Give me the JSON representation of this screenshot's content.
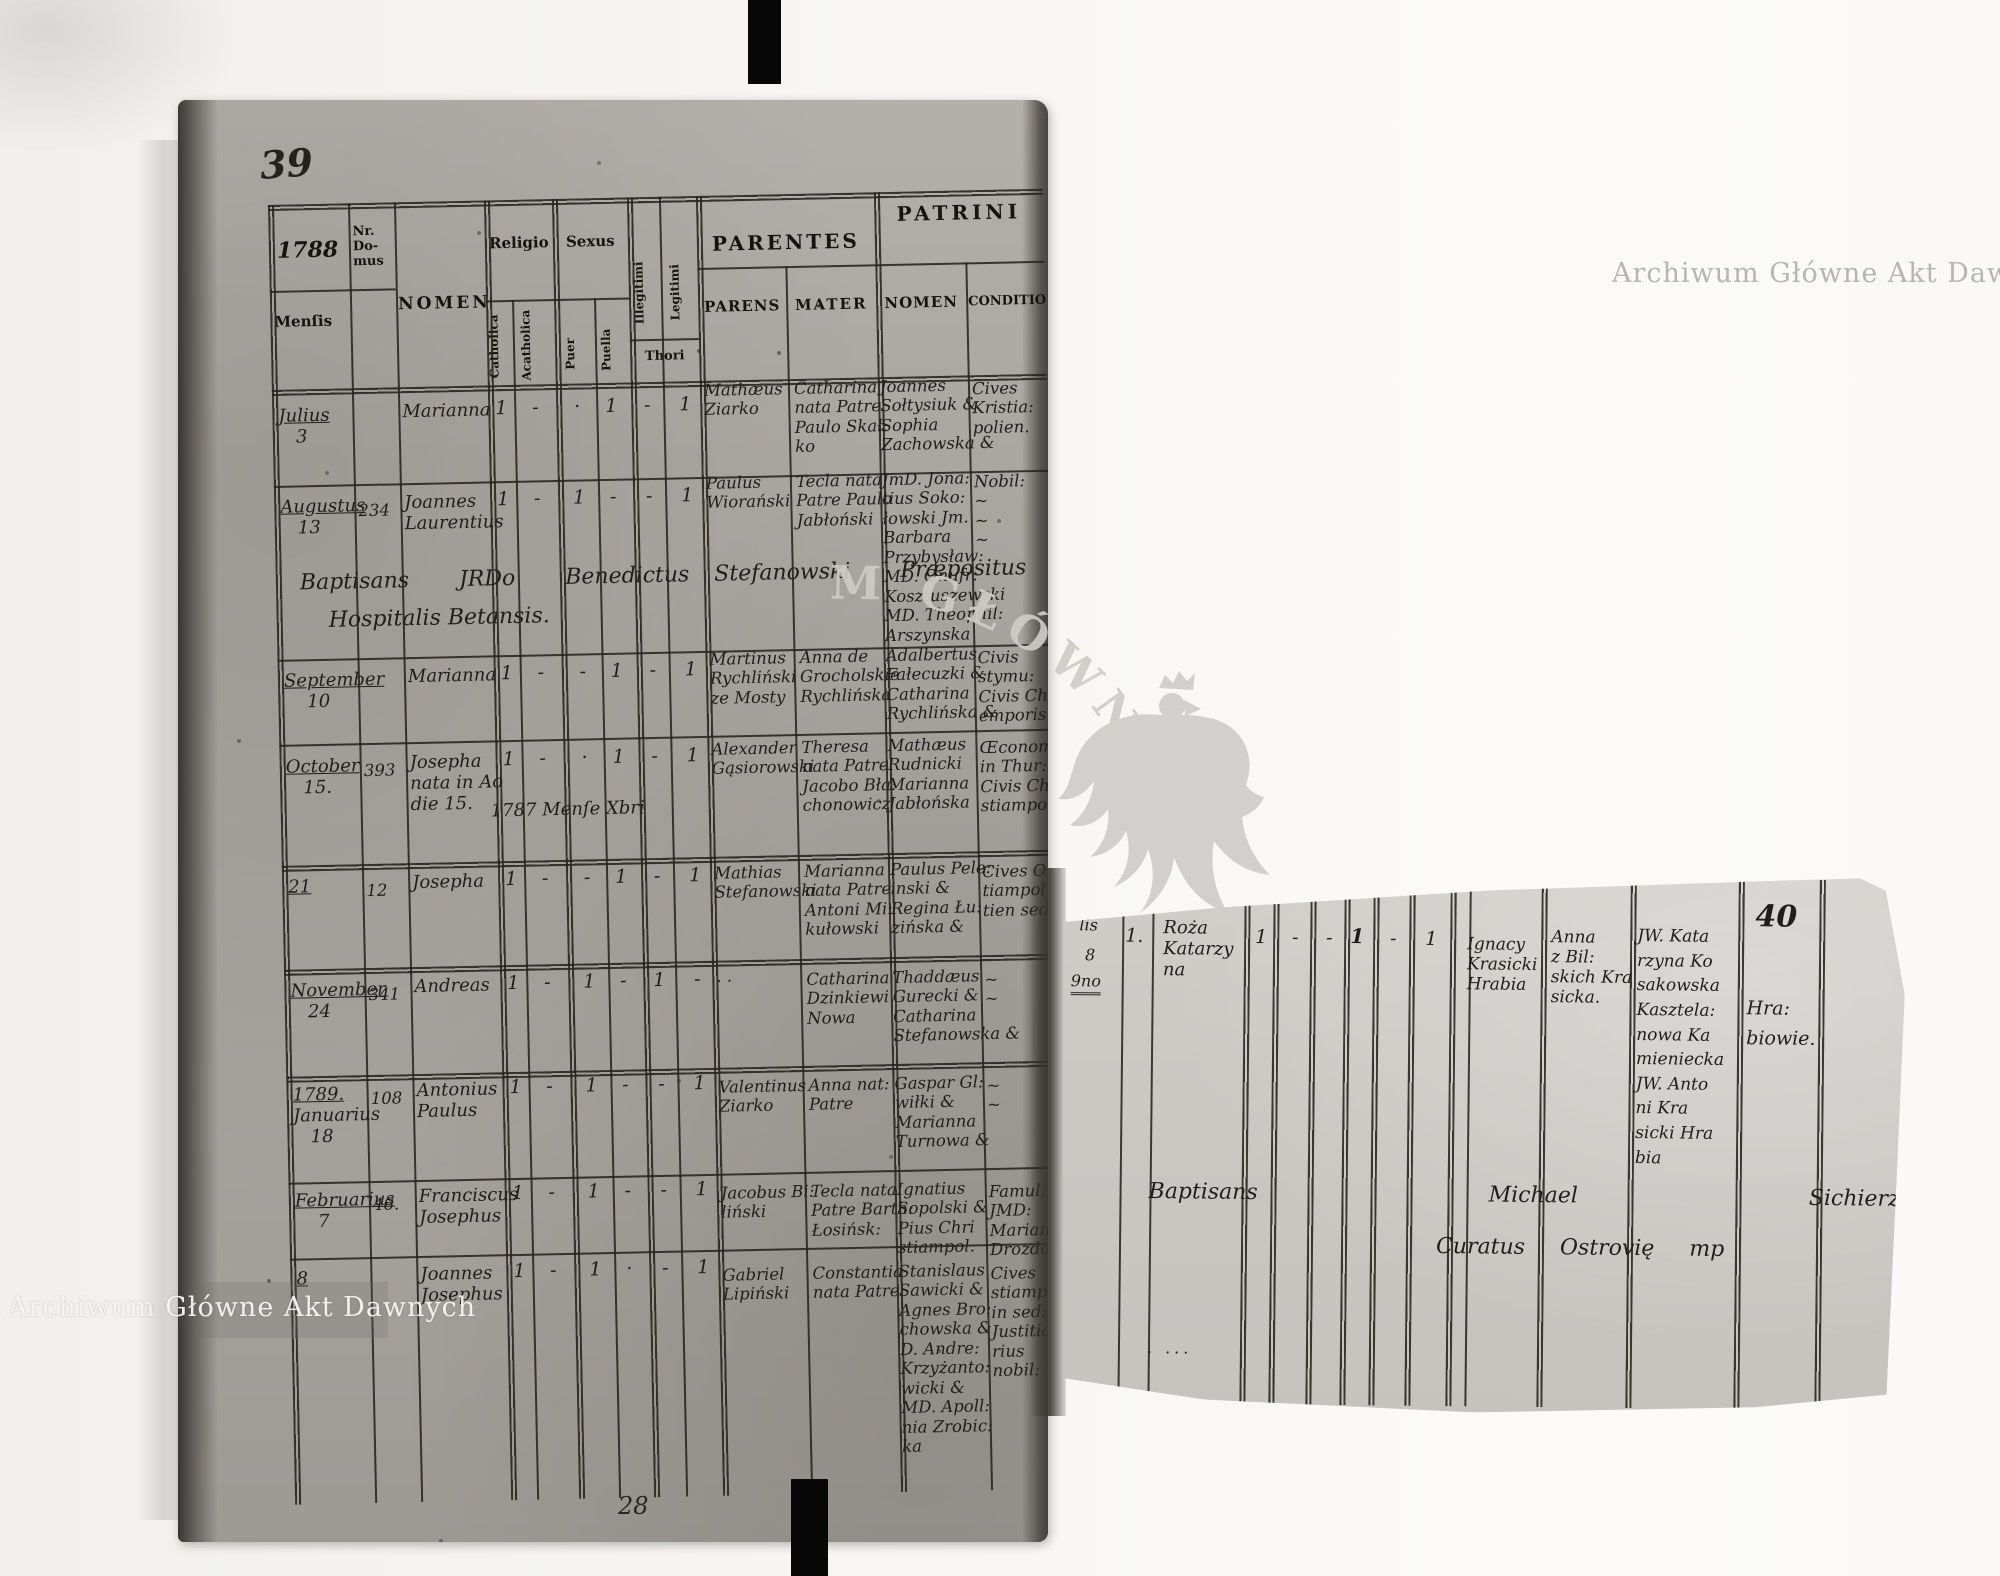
{
  "watermarks": {
    "archive_top_right": "Archiwum Główne Akt Dawnych",
    "archive_bottom_left": "Archiwum Główne Akt Dawnych",
    "emblem_arc_text": "M GŁÓWNE·H"
  },
  "left_page": {
    "page_number": "39",
    "sheet_number": "28",
    "header": {
      "year": "1788",
      "nr": "Nr.\nDo-\nmus",
      "mensis": "Menſis",
      "nomen": "NOMEN",
      "religio": "Religio",
      "catholica": "Catholica",
      "acatholica": "Acatholica",
      "sexus": "Sexus",
      "puer": "Puer",
      "puella": "Puella",
      "illegitimi": "Illegitimi",
      "legitimi": "Legitimi",
      "thori": "Thori",
      "parentes": "PARENTES",
      "parens": "PARENS",
      "mater": "MATER",
      "patrini": "PATRINI",
      "patrini_nomen": "NOMEN",
      "conditio": "CONDITIO"
    },
    "baptism_note": {
      "line1": "Baptisans  JRDo  Benedictus Stefanowski  Præpositus",
      "line2": "Hospitalis Betansis."
    },
    "rows": [
      {
        "mensis": "Julius\n   3",
        "nr": "",
        "nomen": "Marianna",
        "catholica": "1",
        "acatholica": "-",
        "puer": "·",
        "puella": "1",
        "illegitimi": "-",
        "legitimi": "1",
        "parens": "Mathæus\nZiarko",
        "mater": "Catharina\nnata Patre\nPaulo Skał:\nko",
        "patrini": "Joannes\nSołtysiuk &\nSophia\nZachowska &",
        "conditio": "Cives\nKristia:\npolien."
      },
      {
        "mensis": "Augustus\n   13",
        "nr": "234",
        "nomen": "Joannes\nLaurentius",
        "catholica": "1",
        "acatholica": "-",
        "puer": "1",
        "puella": "-",
        "illegitimi": "-",
        "legitimi": "1",
        "parens": "Paulus\nWiorański",
        "mater": "Tecla nata\nPatre Paulo\nJabłoński",
        "patrini": "JmD. Jona:\ntius Soko:\nłowski Jm.\nBarbara\nPrzybysław:\nMD. Onufr:\nKosztuszewski\nMD. Theophil:\nArszynska",
        "conditio": "Nobil:\n~\n~\n~"
      },
      {
        "mensis": "September\n    10",
        "nr": "",
        "nomen": "Marianna",
        "catholica": "1",
        "acatholica": "-",
        "puer": "-",
        "puella": "1",
        "illegitimi": "-",
        "legitimi": "1",
        "parens": "Martinus\nRychliński\nze Mosty",
        "mater": "Anna de\nGrocholskie\nRychlińska",
        "patrini": "Adalbertus\nFałecuzki &\nCatharina\nRychlińska &",
        "conditio": "Civis\nstymu:\nCivis Ch:\nemporis."
      },
      {
        "mensis": "October\n   15.",
        "nr": "393",
        "nomen": "Josepha\nnata in Ao\ndie 15.",
        "spill": "1787 Menſe Xbri",
        "catholica": "1",
        "acatholica": "-",
        "puer": "·",
        "puella": "1",
        "illegitimi": "-",
        "legitimi": "1",
        "parens": "Alexander\nGąsiorowski",
        "mater": "Theresa\nnata Patre\nJacobo Bła:\nchonowicz",
        "patrini": "Mathæus\nRudnicki\nMarianna\nJabłońska",
        "conditio": "Œconom:\nin Thur:\nCivis Chri\nstiampol."
      },
      {
        "mensis": "21",
        "nr": "12",
        "nomen": "Josepha",
        "catholica": "1",
        "acatholica": "-",
        "puer": "-",
        "puella": "1",
        "illegitimi": "-",
        "legitimi": "1",
        "parens": "Mathias\nStefanowski",
        "mater": "Marianna\nnata Patre\nAntoni Mi:\nkułowski",
        "patrini": "Paulus Pele:\ninski &\nRegina Łu:\nzińska &",
        "conditio": "Cives Ob:\ntiampol\ntien sed."
      },
      {
        "mensis": "November\n   24",
        "nr": "341",
        "nomen": "Andreas",
        "catholica": "1",
        "acatholica": "-",
        "puer": "1",
        "puella": "-",
        "illegitimi": "1",
        "legitimi": "-",
        "parens": "· ·",
        "mater": "Catharina\nDzinkiewi\nNowa",
        "patrini": "Thaddæus\nGurecki &\nCatharina\nStefanowska &",
        "conditio": "~\n~"
      },
      {
        "mensis": "1789.\nJanuarius\n   18",
        "nr": "108",
        "nomen": "Antonius\nPaulus",
        "catholica": "1",
        "acatholica": "-",
        "puer": "1",
        "puella": "-",
        "illegitimi": "-",
        "legitimi": "1",
        "parens": "Valentinus\nZiarko",
        "mater": "Anna nat:\nPatre",
        "patrini": "Gaspar Gl:\nwiłki &\nMarianna\nTurnowa &",
        "conditio": "~\n~"
      },
      {
        "mensis": "Februarius\n    7",
        "nr": "46.",
        "nomen": "Franciscus\nJosephus",
        "catholica": "1",
        "acatholica": "-",
        "puer": "1",
        "puella": "-",
        "illegitimi": "-",
        "legitimi": "1",
        "parens": "Jacobus Bi:\nliński",
        "mater": "Tecla nata\nPatre Barth:\nŁosińsk:",
        "patrini": "Ignatius\nSopolski &\nPius Chri\nstiampol.",
        "conditio": "Famul:\nJMD:\nMarian:\nDrozdows:"
      },
      {
        "mensis": "8",
        "nr": "",
        "nomen": "Joannes\nJosephus",
        "catholica": "1",
        "acatholica": "-",
        "puer": "1",
        "puella": "·",
        "illegitimi": "-",
        "legitimi": "1",
        "parens": "Gabriel\nLipiński",
        "mater": "Constantia\nnata Patre",
        "patrini": "Stanislaus\nSawicki &\nAgnes Bro:\nchowska &\nD. Andre:\nKrzyżanto:\nwicki &\nMD. Apoll:\nnia Zrobic:\nka",
        "conditio": "Cives\nstiampol\nin sed:\nJustitia:\nrius\nnobil:"
      }
    ]
  },
  "right_fragment": {
    "page_number": "40",
    "margin_scraps": {
      "a": "lis",
      "b": "8",
      "c": "9no"
    },
    "row": {
      "nr": "1.",
      "nomen": "Roża\nKatarzy\nna",
      "catholica": "1",
      "acatholica": "-",
      "puer": "-",
      "puella": "1",
      "illegitimi": "-",
      "legitimi": "1",
      "parens": "Ignacy\nKrasicki\nHrabia",
      "mater": "Anna\nz Bil:\nskich Kra\nsicka.",
      "patrini": "JW. Kata\nrzyna Ko\nsakowska\nKasztela:\nnowa Ka\nmieniecka\nJW. Anto\nni Kra\nsicki Hra\nbia",
      "conditio": "Hra:\nbiowie."
    },
    "baptism_note": {
      "line1": "Baptisans   Michael   Sichierzynski",
      "line2": "Curatus Ostrovię mp"
    },
    "ink_dots": ". ..."
  }
}
